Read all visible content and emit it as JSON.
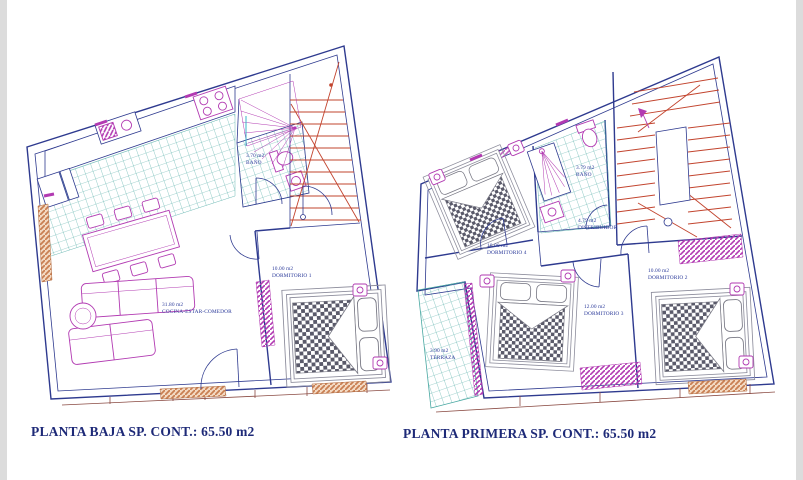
{
  "document": {
    "type": "architectural-floor-plans",
    "background": "#ffffff"
  },
  "colors": {
    "walls": "#2e3a8f",
    "furniture": "#b23ab2",
    "stair_treads": "#c2442e",
    "tile_grid": "#49a8a2",
    "window_sill": "#c97f52",
    "label_text": "#2b3a9a",
    "caption_text": "#1e2a78"
  },
  "plans": [
    {
      "id": "planta-baja",
      "caption": "PLANTA BAJA SP. CONT.: 65.50 m2",
      "rooms": [
        {
          "area": "3.70 m2",
          "label": "BAÑO"
        },
        {
          "area": "31.80 m2",
          "label": "COCINA-ESTAR-COMEDOR"
        },
        {
          "area": "10.00 m2",
          "label": "DORMITORIO 1"
        }
      ]
    },
    {
      "id": "planta-primera",
      "caption": "PLANTA PRIMERA SP. CONT.: 65.50 m2",
      "rooms": [
        {
          "area": "10.00 m2",
          "label": "DORMITORIO 4"
        },
        {
          "area": "3.79 m2",
          "label": "BAÑO"
        },
        {
          "area": "4.79 m2",
          "label": "DISTRIBUIDOR"
        },
        {
          "area": "12.00 m2",
          "label": "DORMITORIO 3"
        },
        {
          "area": "10.00 m2",
          "label": "DORMITORIO 2"
        },
        {
          "area": "3.90 m2",
          "label": "TERRAZA"
        }
      ]
    }
  ]
}
